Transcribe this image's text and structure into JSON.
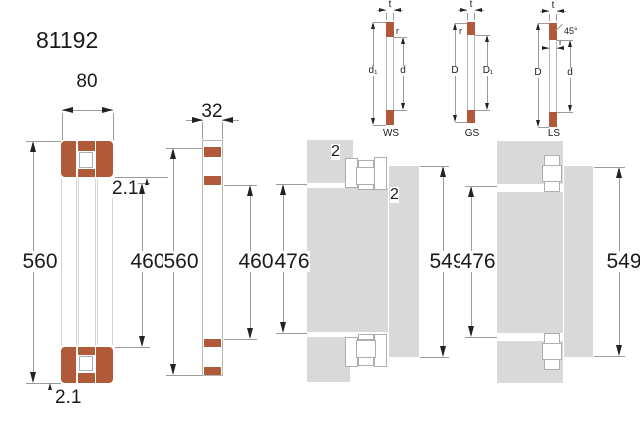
{
  "title": "81192",
  "colors": {
    "washer_brown": "#b15a3a",
    "steel_gray": "#d9d9d9",
    "dim_line": "#9b9b9b",
    "outline_gray": "#adadad",
    "text": "#1a1a1a"
  },
  "cross_section": {
    "width": "80",
    "outer_diameter": "560",
    "bore_diameter": "460",
    "r_top": "2.1",
    "r_bottom": "2.1"
  },
  "washer_view": {
    "width": "32",
    "outer_diameter": "560",
    "bore_diameter": "460"
  },
  "mounting_left": {
    "fillet_top": "2",
    "fillet_side": "2",
    "shaft_abutment": "476",
    "housing_abutment": "549"
  },
  "mounting_right": {
    "shaft_abutment": "476",
    "housing_abutment": "549"
  },
  "mini_diagrams": {
    "ws": {
      "label": "WS",
      "t": "t",
      "r": "r",
      "left_dim": "d₁",
      "right_dim": "d"
    },
    "gs": {
      "label": "GS",
      "t": "t",
      "r": "r",
      "left_dim": "D",
      "right_dim": "D₁"
    },
    "ls": {
      "label": "LS",
      "t": "t",
      "r": "r",
      "angle": "45°",
      "left_dim": "D",
      "right_dim": "d"
    }
  }
}
